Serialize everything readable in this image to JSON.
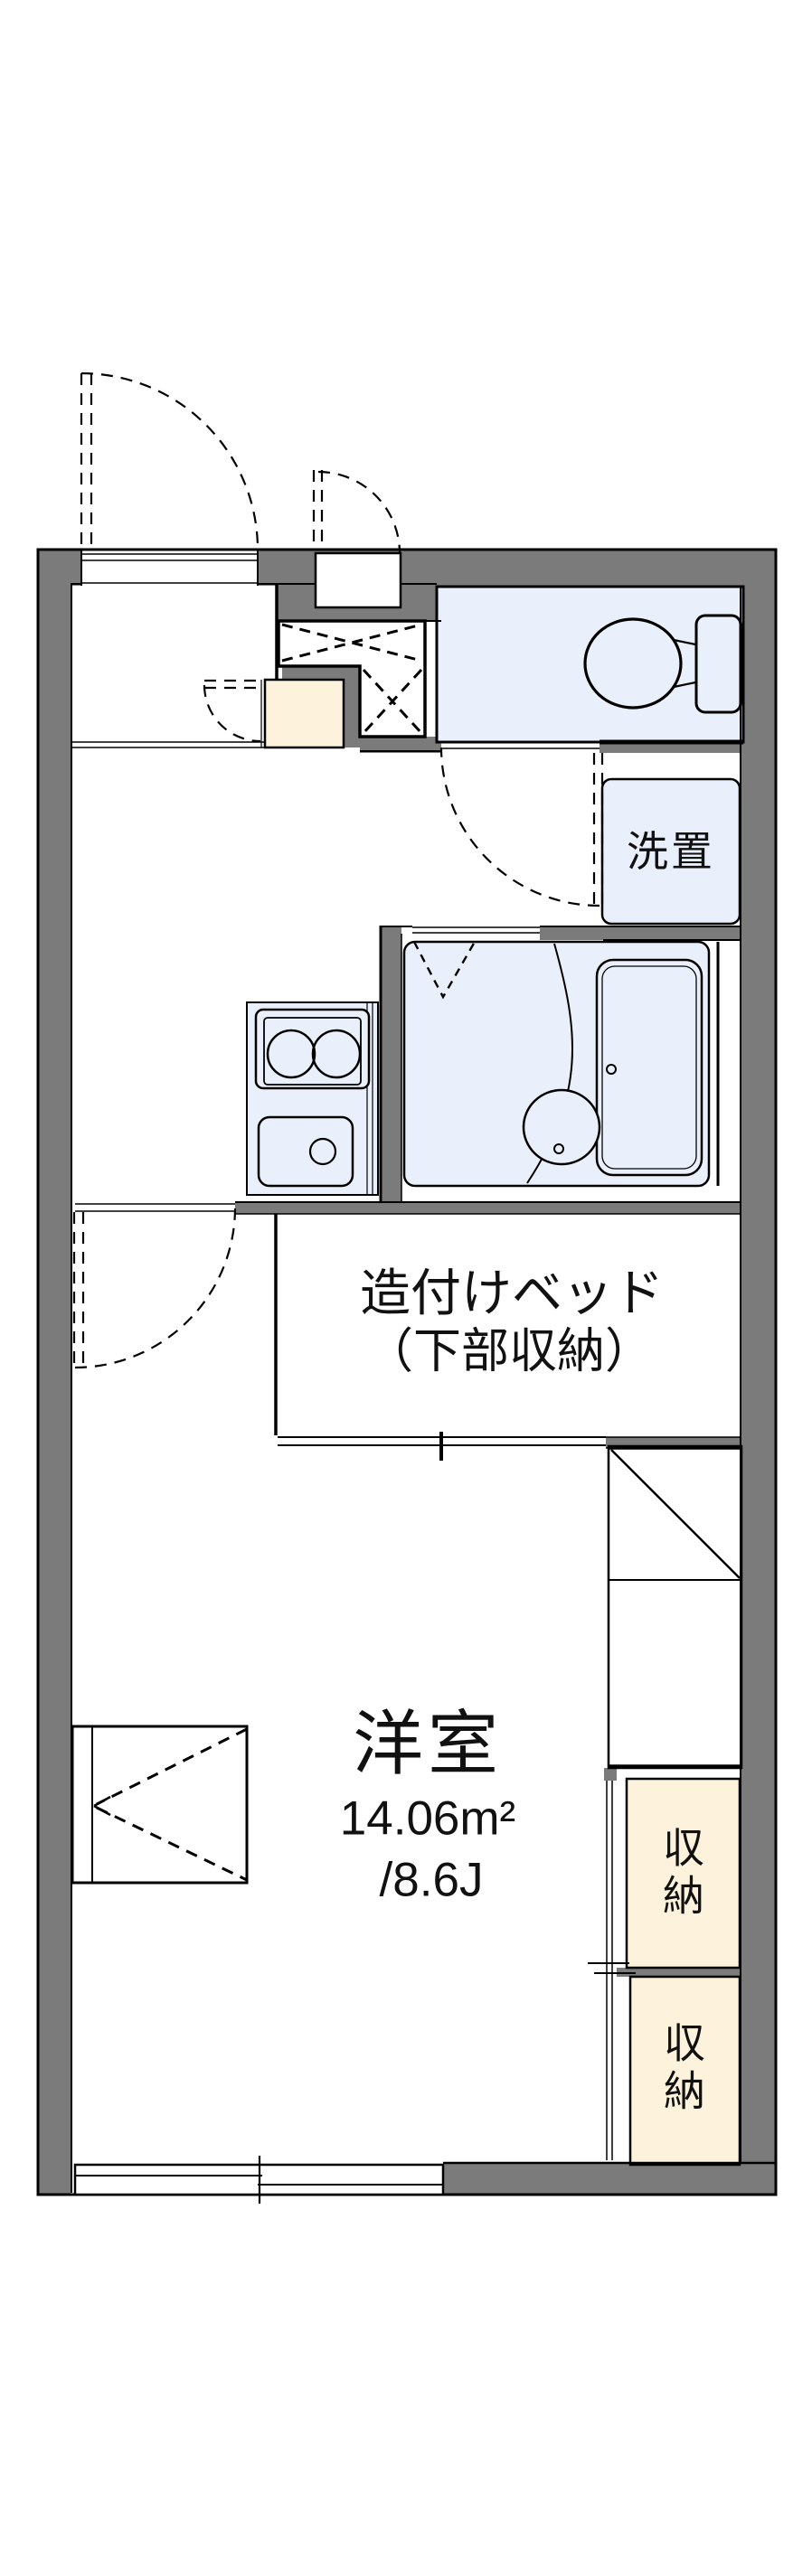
{
  "floorplan": {
    "rooms": {
      "western_room": {
        "name": "洋室",
        "area_sqm": "14.06m²",
        "area_tatami": "/8.6J"
      },
      "built_in_bed": {
        "line1": "造付けベッド",
        "line2": "（下部収納）"
      },
      "laundry": {
        "label": "洗置"
      },
      "storage_upper": {
        "label": "収納"
      },
      "storage_lower": {
        "label": "収納"
      }
    },
    "colors": {
      "wall": "#7b7b7b",
      "room_blue": "#e9effb",
      "cream": "#fdf3dc",
      "line": "#000000",
      "background": "#ffffff"
    }
  }
}
